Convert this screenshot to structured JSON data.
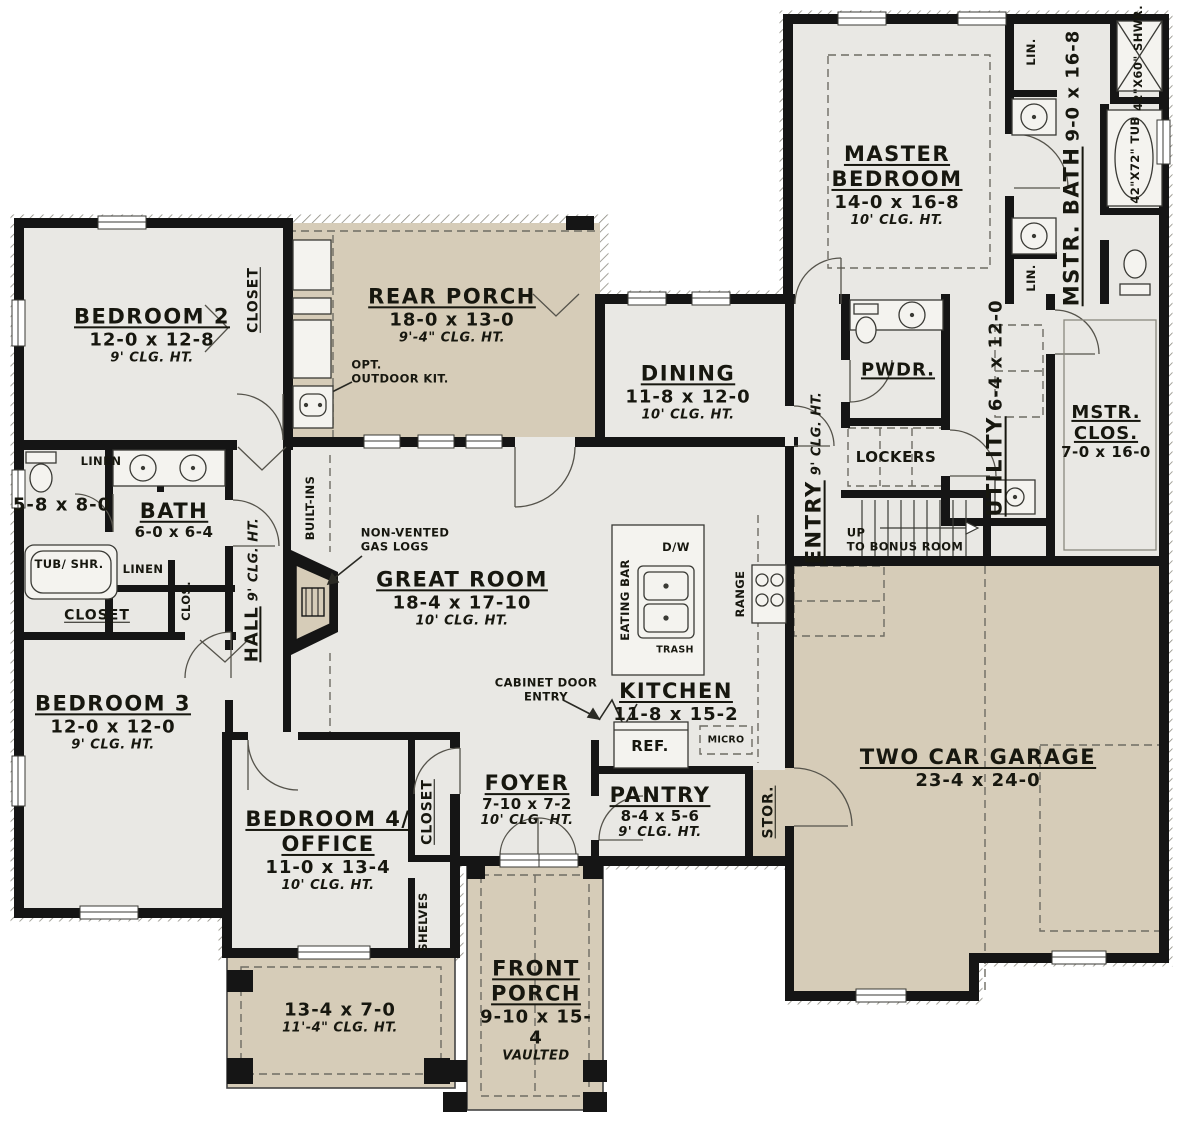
{
  "colors": {
    "interior": "#e9e8e4",
    "porch_tan": "#d6ccb8",
    "wall_black": "#151515",
    "hatch_gray": "#8e8c82",
    "dash_gray": "#6e6c63"
  },
  "rooms": {
    "master_bedroom": {
      "name": "MASTER BEDROOM",
      "dims": "14-0 x 16-8",
      "clg": "10' CLG. HT."
    },
    "mstr_bath": {
      "name": "MSTR. BATH",
      "dims": "9-0 x 16-8"
    },
    "mstr_clos": {
      "name": "MSTR. CLOS.",
      "dims": "7-0 x 16-0"
    },
    "bedroom2": {
      "name": "BEDROOM 2",
      "dims": "12-0 x 12-8",
      "clg": "9' CLG. HT."
    },
    "bedroom3": {
      "name": "BEDROOM 3",
      "dims": "12-0 x 12-0",
      "clg": "9' CLG. HT."
    },
    "bedroom4": {
      "name": "BEDROOM 4/ OFFICE",
      "dims": "11-0 x 13-4",
      "clg": "10' CLG. HT."
    },
    "bath": {
      "name": "BATH",
      "dims": "6-0 x 6-4"
    },
    "bath_wc": {
      "dims": "5-8 x 8-0"
    },
    "rear_porch": {
      "name": "REAR PORCH",
      "dims": "18-0 x 13-0",
      "clg": "9'-4\" CLG. HT."
    },
    "dining": {
      "name": "DINING",
      "dims": "11-8 x 12-0",
      "clg": "10' CLG. HT."
    },
    "great_room": {
      "name": "GREAT ROOM",
      "dims": "18-4 x 17-10",
      "clg": "10' CLG. HT."
    },
    "kitchen": {
      "name": "KITCHEN",
      "dims": "11-8 x 15-2"
    },
    "pantry": {
      "name": "PANTRY",
      "dims": "8-4 x 5-6",
      "clg": "9' CLG. HT."
    },
    "foyer": {
      "name": "FOYER",
      "dims": "7-10 x 7-2",
      "clg": "10' CLG. HT."
    },
    "entry": {
      "name": "ENTRY",
      "clg": "9' CLG. HT."
    },
    "hall": {
      "name": "HALL",
      "clg": "9' CLG. HT."
    },
    "utility": {
      "name": "UTILITY",
      "dims": "6-4 x 12-0"
    },
    "pwdr": {
      "name": "PWDR."
    },
    "garage": {
      "name": "TWO CAR GARAGE",
      "dims": "23-4 x 24-0"
    },
    "front_porch": {
      "name": "FRONT PORCH",
      "dims": "9-10 x 15-4",
      "note": "VAULTED"
    },
    "side_porch": {
      "dims": "13-4 x 7-0",
      "clg": "11'-4\" CLG. HT."
    }
  },
  "annotations": {
    "stairs_up": "UP",
    "stairs_dest": "TO BONUS ROOM",
    "opt_outdoor_kit_1": "OPT.",
    "opt_outdoor_kit_2": "OUTDOOR KIT.",
    "non_vented_1": "NON-VENTED",
    "non_vented_2": "GAS LOGS",
    "cabinet_door_1": "CABINET DOOR",
    "cabinet_door_2": "ENTRY",
    "shower_size": "42\"X60\" SHWR.",
    "tub_size": "42\"X72\" TUB",
    "lin": "LIN.",
    "linen": "LINEN",
    "closet": "CLOSET",
    "clos": "CLOS.",
    "tub_shr": "TUB/ SHR.",
    "built_ins": "BUILT-INS",
    "shelves": "SHELVES",
    "lockers": "LOCKERS",
    "stor": "STOR.",
    "eating_bar": "EATING BAR",
    "dw": "D/W",
    "trash": "TRASH",
    "range": "RANGE",
    "ref": "REF.",
    "micro": "MICRO"
  }
}
